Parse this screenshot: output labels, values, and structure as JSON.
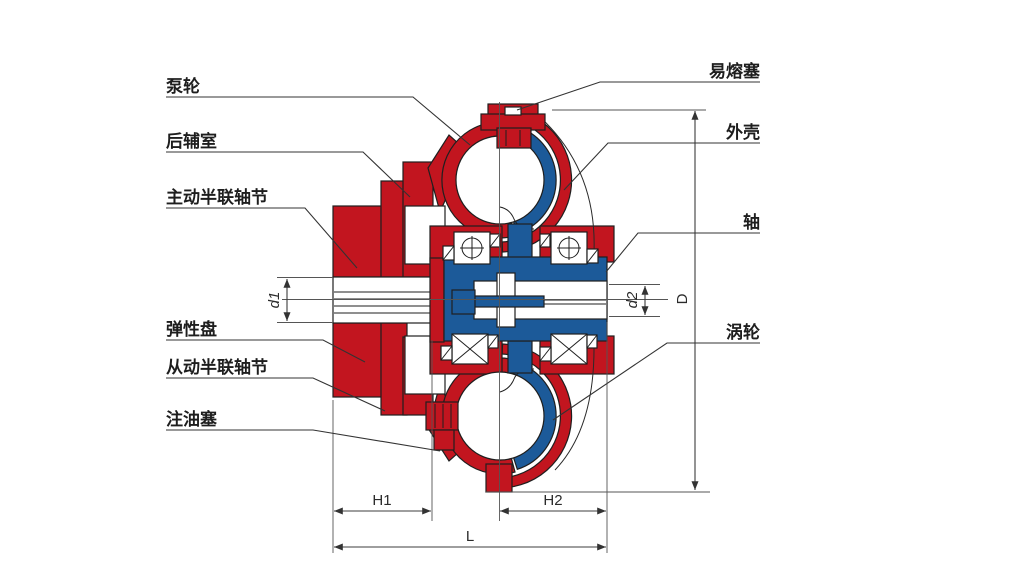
{
  "colors": {
    "red": "#c2151f",
    "blue": "#1c5a99",
    "outline": "#1f1f1f",
    "dim": "#3c3c3c",
    "text": "#1e1e1e",
    "bg": "#ffffff"
  },
  "labels": {
    "pump_wheel": "泵轮",
    "rear_chamber": "后辅室",
    "driving_half_coupling": "主动半联轴节",
    "elastic_disc": "弹性盘",
    "driven_half_coupling": "从动半联轴节",
    "oil_fill_plug": "注油塞",
    "fusible_plug": "易熔塞",
    "housing": "外壳",
    "shaft": "轴",
    "turbine": "涡轮"
  },
  "dimensions": {
    "d1": "d1",
    "d2": "d2",
    "D": "D",
    "H1": "H1",
    "H2": "H2",
    "L": "L"
  }
}
